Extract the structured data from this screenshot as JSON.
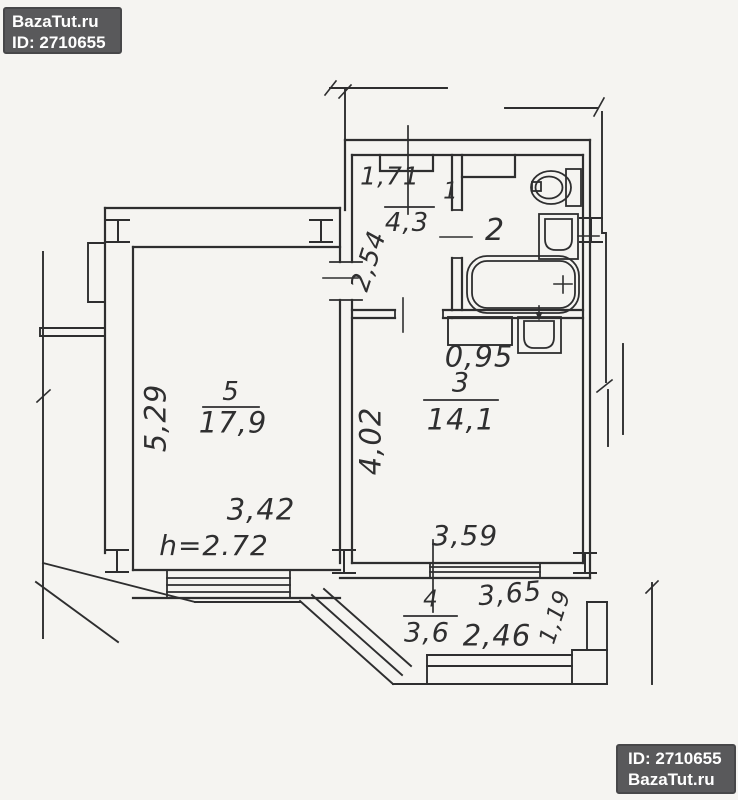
{
  "badge_top": {
    "line1": "BazaTut.ru",
    "line2": "ID: 2710655"
  },
  "badge_bottom": {
    "line1": "ID: 2710655",
    "line2": "BazaTut.ru"
  },
  "plan": {
    "room1": {
      "number": "1",
      "area": "4,3",
      "dim_width": "1,71",
      "dim_depth": "2,54"
    },
    "room2": {
      "number": "2"
    },
    "room3": {
      "number": "3",
      "area": "14,1",
      "dim_depth": "4,02",
      "dim_width": "3,59",
      "dim_niche": "0,95"
    },
    "room4": {
      "number": "4",
      "area": "3,6",
      "dim_len": "3,65",
      "dim_inner": "2,46",
      "dim_side": "1,19"
    },
    "room5": {
      "number": "5",
      "area": "17,9",
      "dim_depth": "5,29",
      "dim_width": "3,42",
      "dim_height": "h=2.72"
    }
  },
  "colors": {
    "line": "#2e2e2f",
    "paper": "#f5f4f1",
    "badge_bg": "#59595b",
    "badge_text": "#ffffff"
  }
}
